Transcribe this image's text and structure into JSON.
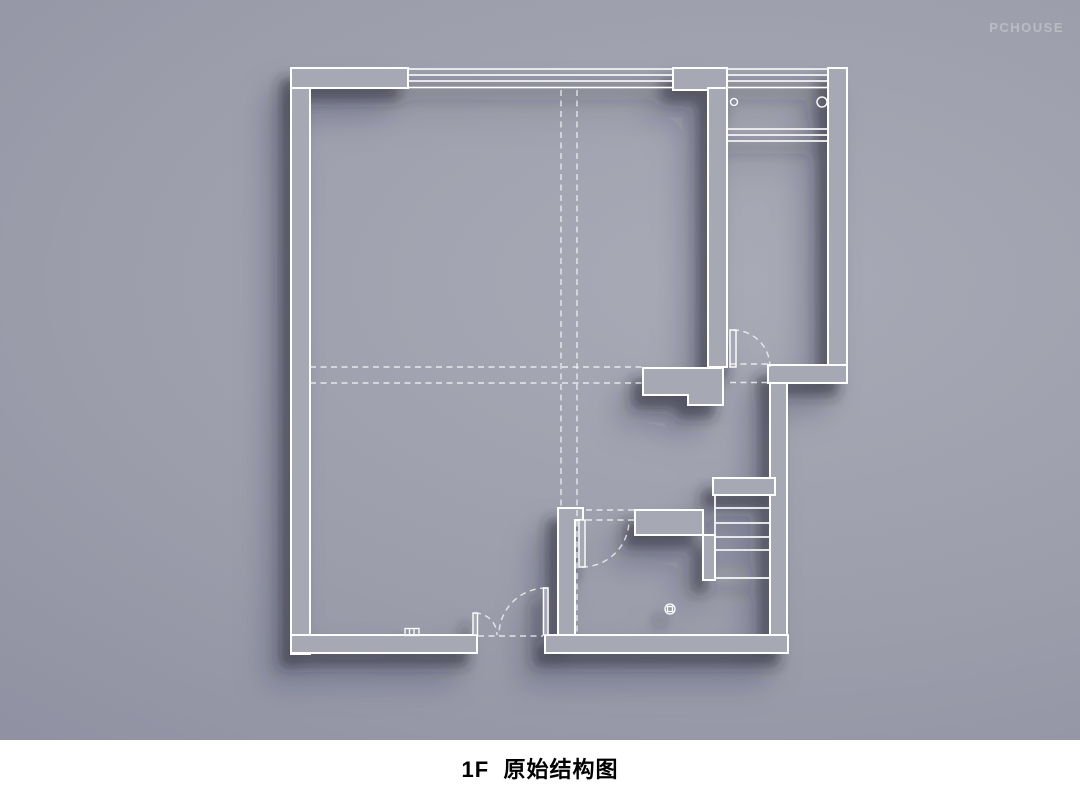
{
  "watermark": {
    "text": "PCHOUSE"
  },
  "caption": {
    "text": "1F  原始结构图"
  },
  "colors": {
    "bg_outer": "#8b8d9f",
    "bg_mid": "#9b9dab",
    "bg_inner": "#a8aab6",
    "wall_fill": "#a6a8b4",
    "line": "#ffffff",
    "shadow": "#262838",
    "caption_text": "#000000",
    "caption_bg": "#ffffff",
    "watermark": "rgba(255,255,255,0.30)"
  },
  "floor_plan": {
    "type": "architectural-floor-plan",
    "floor": "1F",
    "title": "原始结构图",
    "features": [
      "exterior-walls",
      "top-window-4-lines",
      "balcony-window-4-lines",
      "balcony-railing-3-lines",
      "balcony-pipe-circles",
      "entry-door-with-swing-arc",
      "interior-partition-walls",
      "double-door-bottom-wall",
      "bathroom-door-with-swing-arc",
      "staircase-with-treads",
      "floor-drain",
      "wall-switch-symbol",
      "dashed-beam-lines"
    ]
  }
}
